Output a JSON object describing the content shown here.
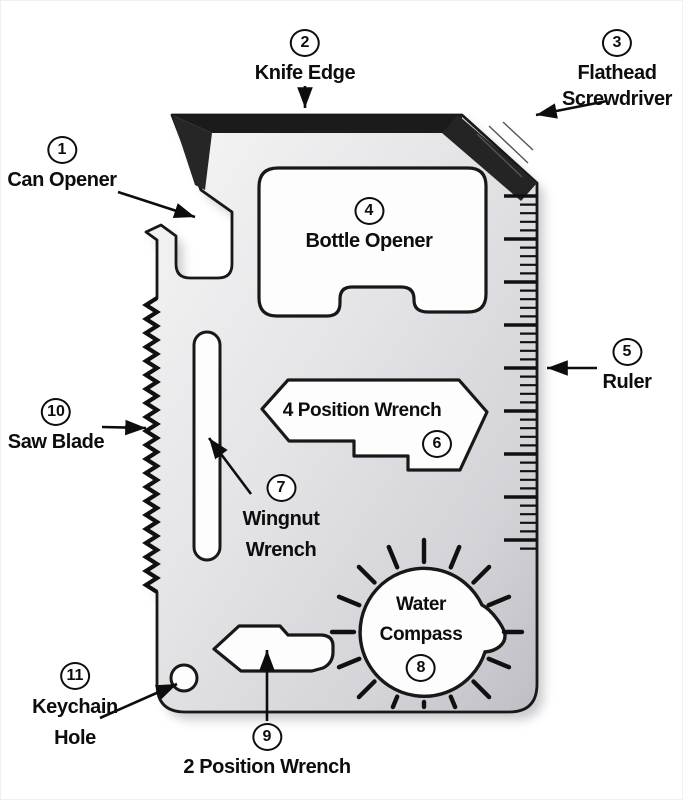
{
  "diagram": {
    "subject": "11-in-1 credit card multi-tool, numbered parts diagram",
    "labels": {
      "can_opener": {
        "num": "1",
        "text": "Can Opener"
      },
      "knife_edge": {
        "num": "2",
        "text": "Knife Edge"
      },
      "flathead": {
        "num": "3",
        "line1": "Flathead",
        "line2": "Screwdriver"
      },
      "bottle_opener": {
        "num": "4",
        "text": "Bottle Opener"
      },
      "ruler": {
        "num": "5",
        "text": "Ruler"
      },
      "four_position_wrench": {
        "num": "6",
        "text": "4 Position Wrench"
      },
      "wingnut": {
        "num": "7",
        "line1": "Wingnut",
        "line2": "Wrench"
      },
      "water_compass": {
        "num": "8",
        "line1": "Water",
        "line2": "Compass"
      },
      "two_position_wrench": {
        "num": "9",
        "text": "2 Position Wrench"
      },
      "saw_blade": {
        "num": "10",
        "text": "Saw Blade"
      },
      "keychain": {
        "num": "11",
        "line1": "Keychain",
        "line2": "Hole"
      }
    },
    "colors": {
      "background": "#ffffff",
      "metal_light": "#f6f6f6",
      "metal_dark": "#bebec5",
      "bevel_dark": "#1e1e1e",
      "line_black": "#0d0d0d"
    }
  }
}
